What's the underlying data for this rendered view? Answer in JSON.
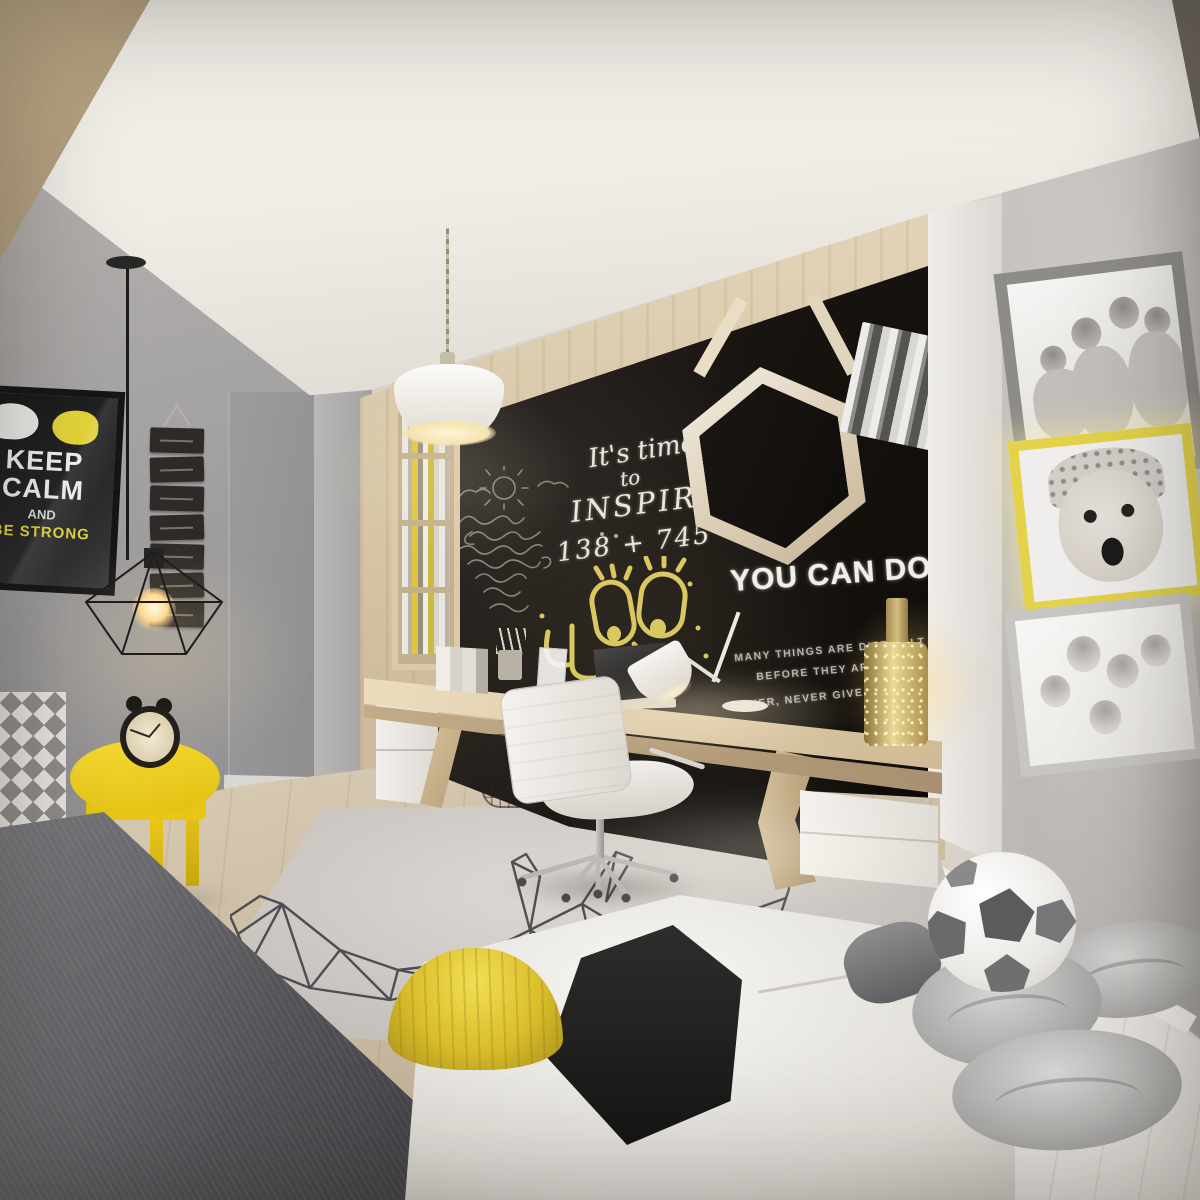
{
  "poster": {
    "word1": "KEEP",
    "word2": "CALM",
    "word3": "AND",
    "word4": "BE STRONG"
  },
  "chalkboard": {
    "script_line1": "It's time",
    "script_line2": "to",
    "script_line3": "INSPIRE",
    "equation": "138 + 745 = 88",
    "headline": "YOU CAN DO IT !",
    "quote_line1": "MANY THINGS ARE DIFFICULT",
    "quote_line2": "BEFORE THEY ARE EASY.",
    "quote_line3": "NEVER, NEVER GIVE UP!"
  },
  "counts": {
    "organizer_cards": 7,
    "photo_frames": 3,
    "floor_cushions": 3,
    "bookshelf_shelves": 4
  },
  "colors": {
    "accent_yellow": "#f2ce1b",
    "chalkboard_black": "#17130f",
    "wood_light": "#dcc9a8",
    "wall_gray": "#a5a3a4",
    "chalk_white": "#eae6dd",
    "doodle_yellow": "#d9c75f"
  }
}
